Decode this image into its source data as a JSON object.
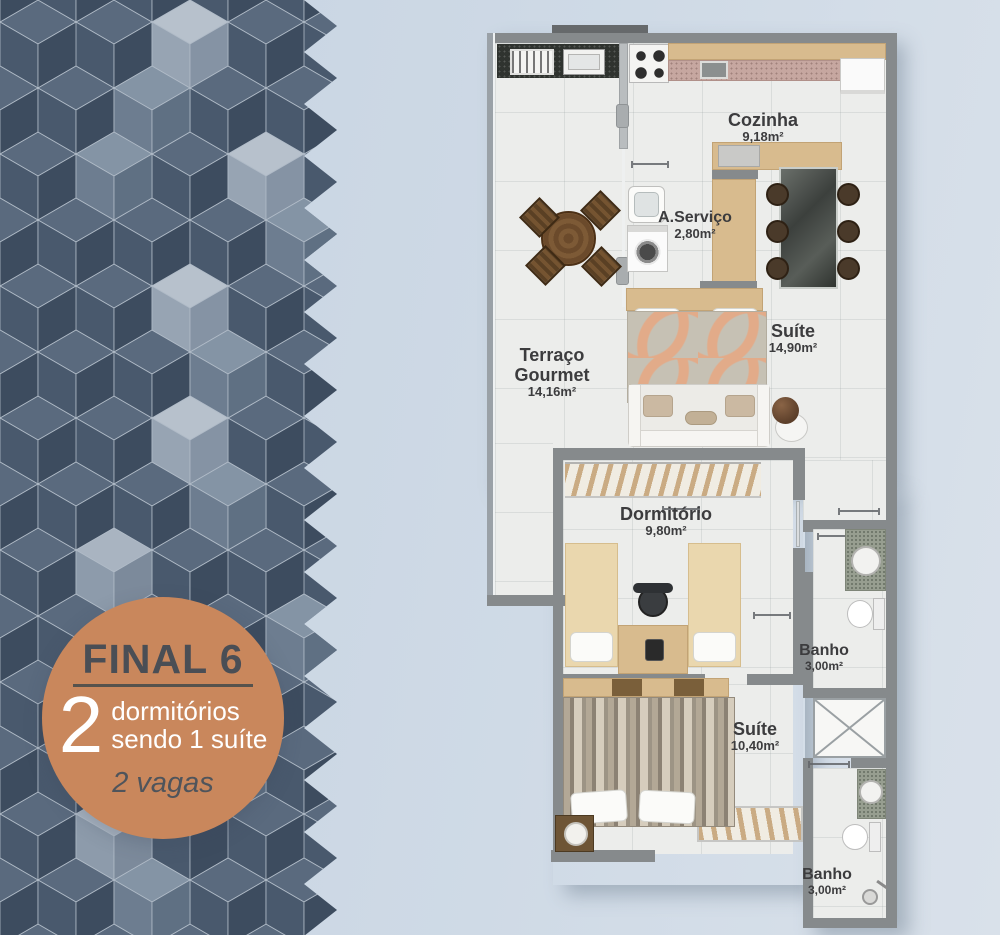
{
  "badge": {
    "title": "FINAL 6",
    "count": "2",
    "line1": "dormitórios",
    "line2": "sendo 1 suíte",
    "vagas": "2 vagas"
  },
  "rooms": {
    "cozinha": {
      "name": "Cozinha",
      "area": "9,18m²"
    },
    "aservico": {
      "name": "A.Serviço",
      "area": "2,80m²"
    },
    "suite1": {
      "name": "Suíte",
      "area": "14,90m²"
    },
    "terraco": {
      "name_line1": "Terraço",
      "name_line2": "Gourmet",
      "area": "14,16m²"
    },
    "dormitorio": {
      "name": "Dormitório",
      "area": "9,80m²"
    },
    "banho1": {
      "name": "Banho",
      "area": "3,00m²"
    },
    "suite2": {
      "name": "Suíte",
      "area": "10,40m²"
    },
    "banho2": {
      "name": "Banho",
      "area": "3,00m²"
    }
  },
  "colors": {
    "badge_orange": "#c9875c",
    "badge_text_dark": "#4a4e55",
    "wall_gray": "#868a8c",
    "floor": "#ecedeb",
    "wood_tan": "#d8bb8e",
    "cube_dark": "#3d4c5f",
    "cube_light": "#b7c1cc",
    "background": "#cfdae6"
  }
}
